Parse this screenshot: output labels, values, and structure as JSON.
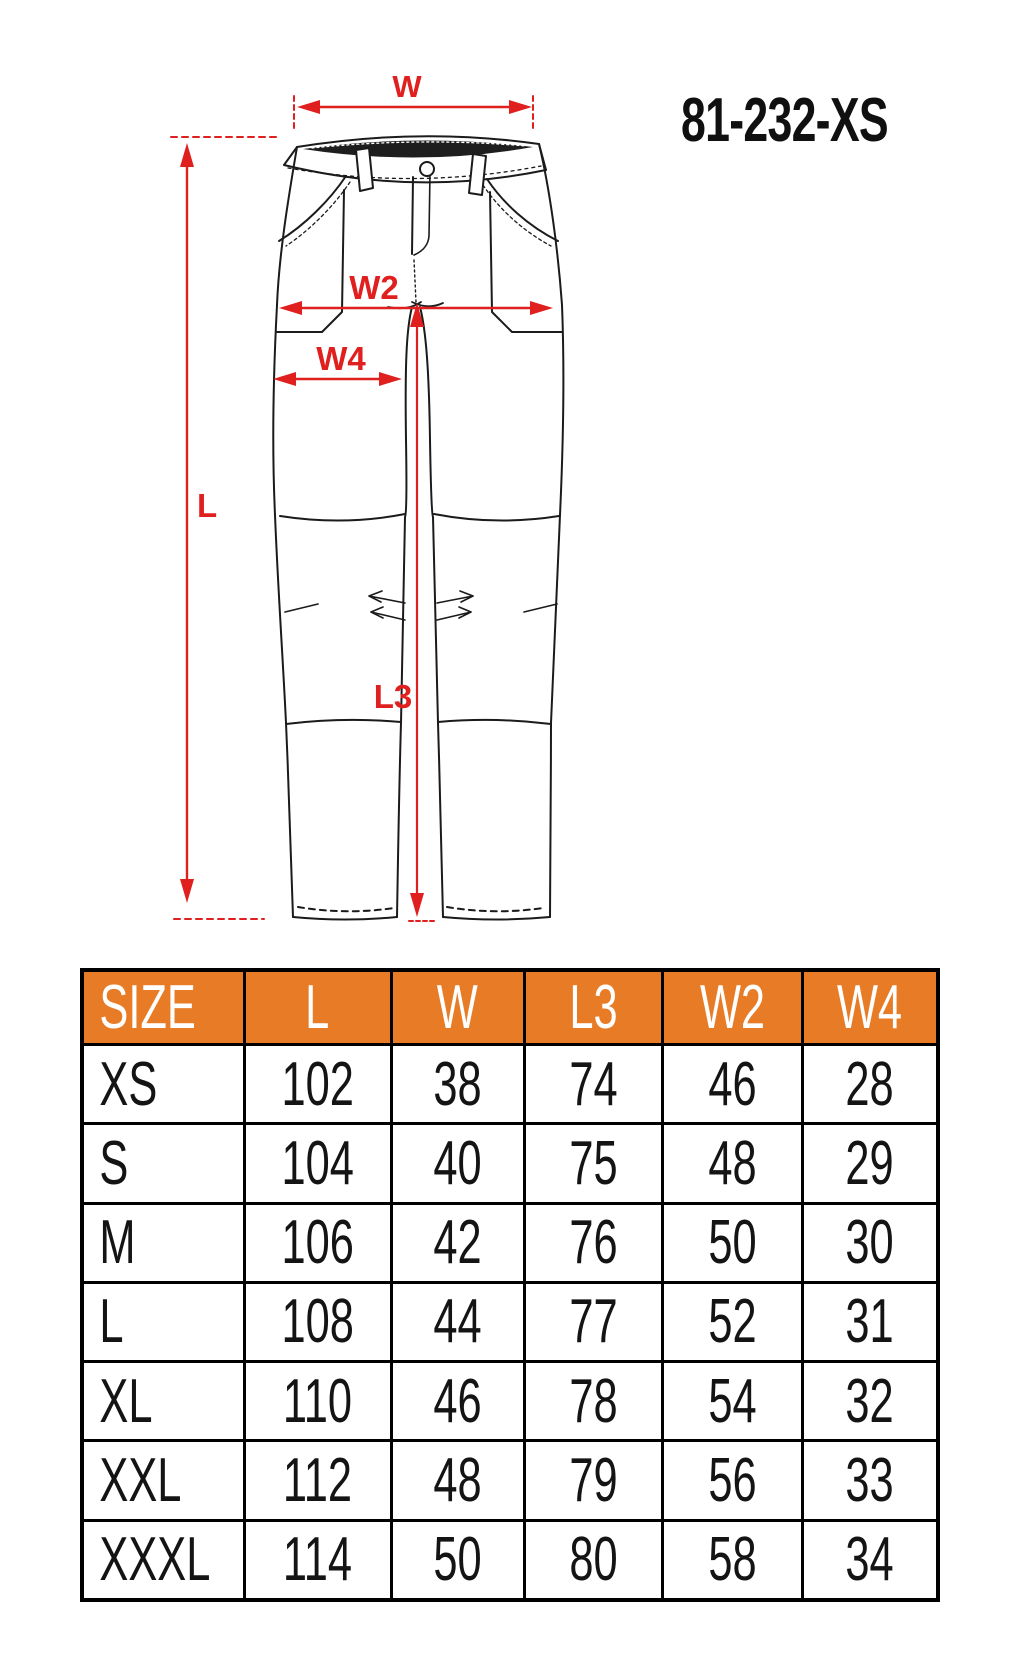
{
  "product_code": "81-232-XS",
  "diagram": {
    "labels": {
      "w": "W",
      "l": "L",
      "w2": "W2",
      "w4": "W4",
      "l3": "L3"
    },
    "accent_red": "#e01f1f",
    "line_black": "#1b1b1b"
  },
  "size_table": {
    "header_bg": "#e87c26",
    "header_text_color": "#ffffff",
    "columns": [
      "SIZE",
      "L",
      "W",
      "L3",
      "W2",
      "W4"
    ],
    "rows": [
      {
        "size": "XS",
        "values": [
          "102",
          "38",
          "74",
          "46",
          "28"
        ]
      },
      {
        "size": "S",
        "values": [
          "104",
          "40",
          "75",
          "48",
          "29"
        ]
      },
      {
        "size": "M",
        "values": [
          "106",
          "42",
          "76",
          "50",
          "30"
        ]
      },
      {
        "size": "L",
        "values": [
          "108",
          "44",
          "77",
          "52",
          "31"
        ]
      },
      {
        "size": "XL",
        "values": [
          "110",
          "46",
          "78",
          "54",
          "32"
        ]
      },
      {
        "size": "XXL",
        "values": [
          "112",
          "48",
          "79",
          "56",
          "33"
        ]
      },
      {
        "size": "XXXL",
        "values": [
          "114",
          "50",
          "80",
          "58",
          "34"
        ]
      }
    ]
  }
}
